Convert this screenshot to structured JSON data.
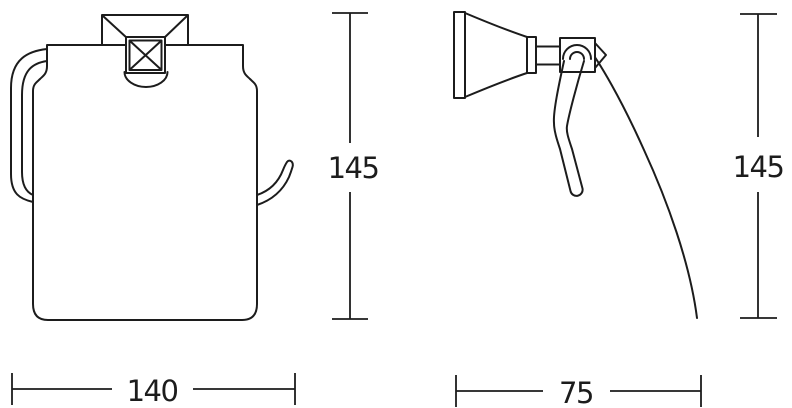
{
  "page": {
    "background_color": "#ffffff",
    "line_color": "#1c1c1c"
  },
  "drawing": {
    "subject": "toilet-paper-holder-technical-drawing",
    "views": [
      "front-view",
      "side-view"
    ],
    "dimensions": {
      "front_height": "145",
      "front_width": "140",
      "side_height": "145",
      "side_depth": "75"
    }
  }
}
